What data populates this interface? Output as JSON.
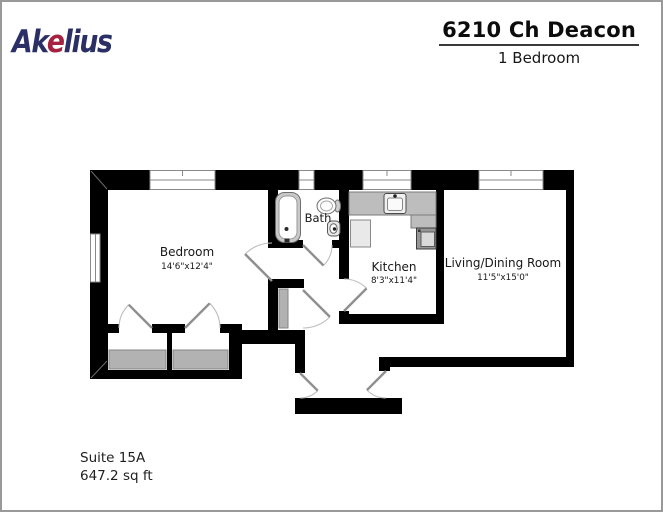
{
  "header": {
    "logo": {
      "part1": "Ak",
      "accent": "e",
      "part2": "lius",
      "navy": "#2a2f66",
      "red": "#a22240"
    },
    "title": "6210 Ch Deacon",
    "subtitle": "1 Bedroom"
  },
  "floorplan": {
    "rooms": [
      {
        "name": "Bedroom",
        "dimensions": "14'6\"x12'4\""
      },
      {
        "name": "Bath",
        "dimensions": ""
      },
      {
        "name": "Kitchen",
        "dimensions": "8'3\"x11'4\""
      },
      {
        "name": "Living/Dining Room",
        "dimensions": "11'5\"x15'0\""
      }
    ],
    "colors": {
      "wall": "#000000",
      "door": "#8f8f8f",
      "door_arc": "#bdbdbd",
      "window_frame": "#8a8a8a",
      "shelf_gray": "#b2b2b2",
      "counter_gray": "#bdbdbd"
    }
  },
  "footer": {
    "suite": "Suite 15A",
    "area": "647.2 sq ft"
  }
}
